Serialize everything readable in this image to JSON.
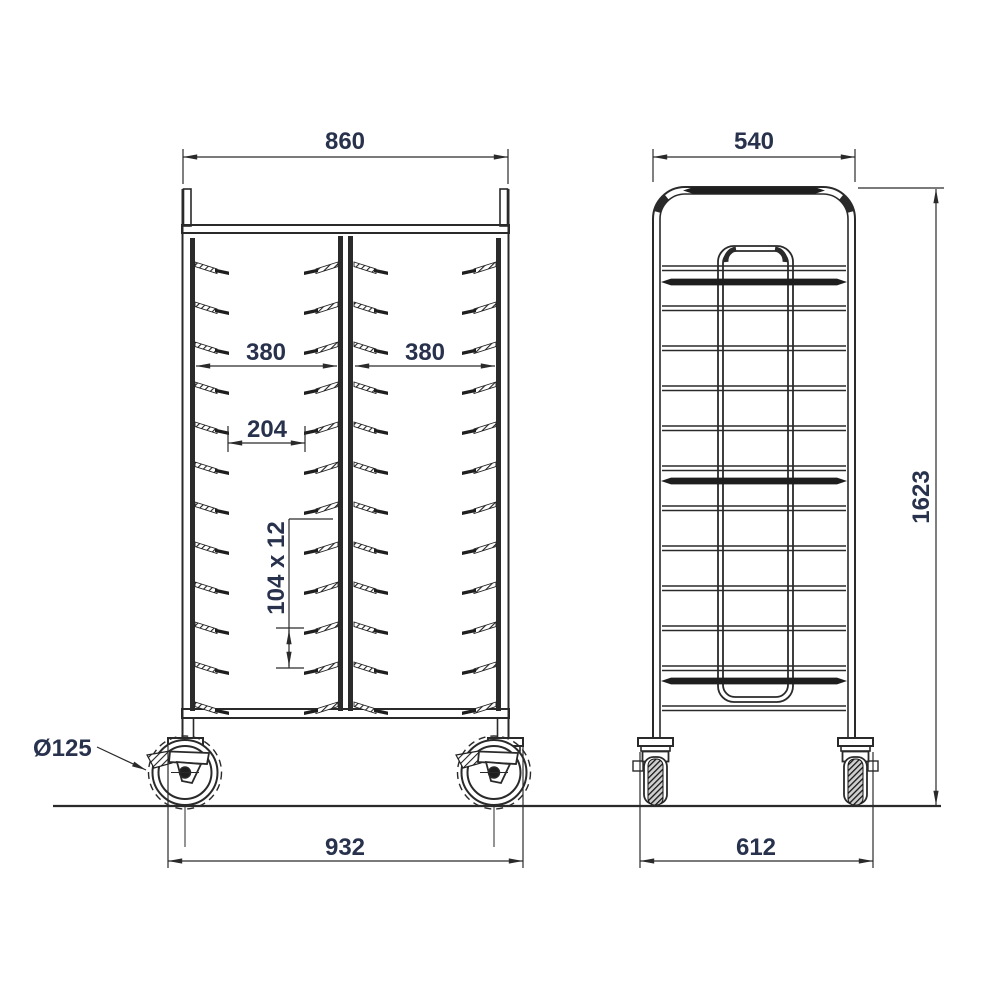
{
  "drawing": {
    "structure": {
      "tray_levels": 12,
      "tray_columns": 2,
      "casters": 4
    },
    "dimensions": {
      "front_width": "860",
      "side_depth": "540",
      "column_width_left": "380",
      "column_width_right": "380",
      "support_clearance": "204",
      "support_pitch": "104 x 12",
      "overall_height": "1623",
      "caster_diameter": "Ø125",
      "front_footprint": "932",
      "side_footprint": "612"
    },
    "colors": {
      "line": "#2a2a2a",
      "dim_text": "#28324c",
      "background": "#ffffff"
    }
  }
}
